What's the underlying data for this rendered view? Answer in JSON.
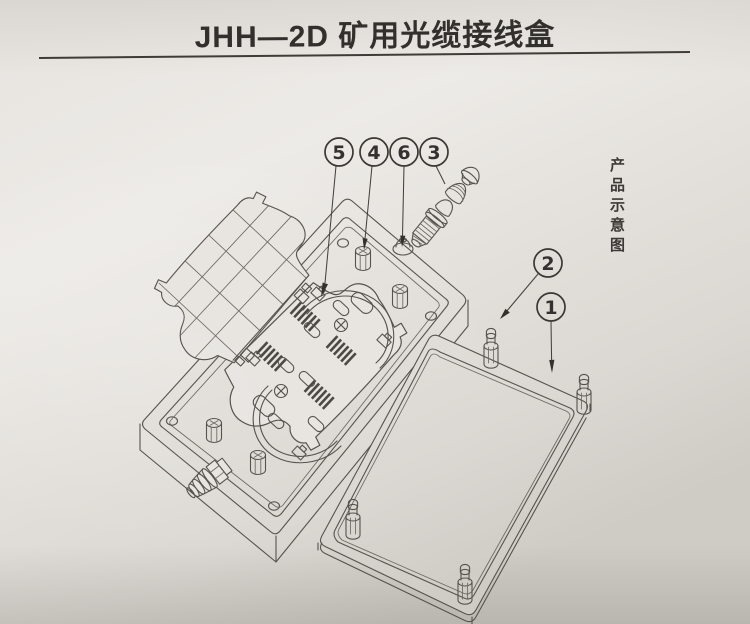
{
  "page": {
    "title": "JHH—2D 矿用光缆接线盒",
    "side_caption": "产品示意图"
  },
  "diagram": {
    "kind": "exploded-assembly-line-drawing",
    "callouts": [
      {
        "label": "5"
      },
      {
        "label": "4"
      },
      {
        "label": "6"
      },
      {
        "label": "3"
      },
      {
        "label": "2"
      },
      {
        "label": "1"
      }
    ],
    "colors": {
      "paper": "#e6e3df",
      "line": "#56534e",
      "ink": "#32302c"
    }
  }
}
